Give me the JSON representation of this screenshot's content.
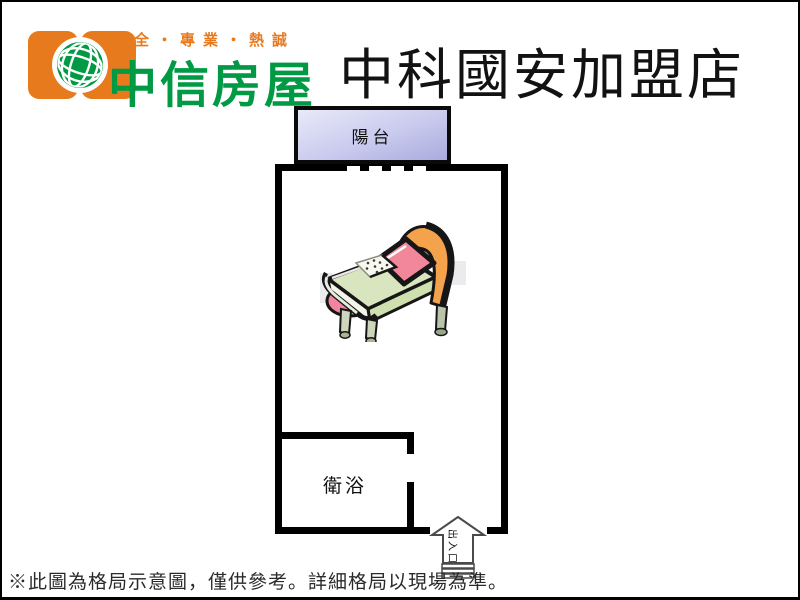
{
  "header": {
    "tagline": "安全・專業・熱誠",
    "brand": "中信房屋",
    "store_title": "中科國安加盟店"
  },
  "floorplan": {
    "balcony_label": "陽台",
    "bathroom_label": "衛浴",
    "entrance_label": "出入口"
  },
  "footer": {
    "disclaimer": "※此圖為格局示意圖，僅供參考。詳細格局以現場為準。"
  },
  "icons": {
    "logo": "globe-icon",
    "furniture": "bed-icon",
    "entrance": "arrow-up-icon"
  },
  "colors": {
    "brand_green": "#009a44",
    "brand_orange": "#e87a1e",
    "wall_black": "#000000",
    "balcony_light": "#e9e9f8",
    "balcony_dark": "#a9abdd",
    "arrow_outline": "#4a4a4a"
  }
}
